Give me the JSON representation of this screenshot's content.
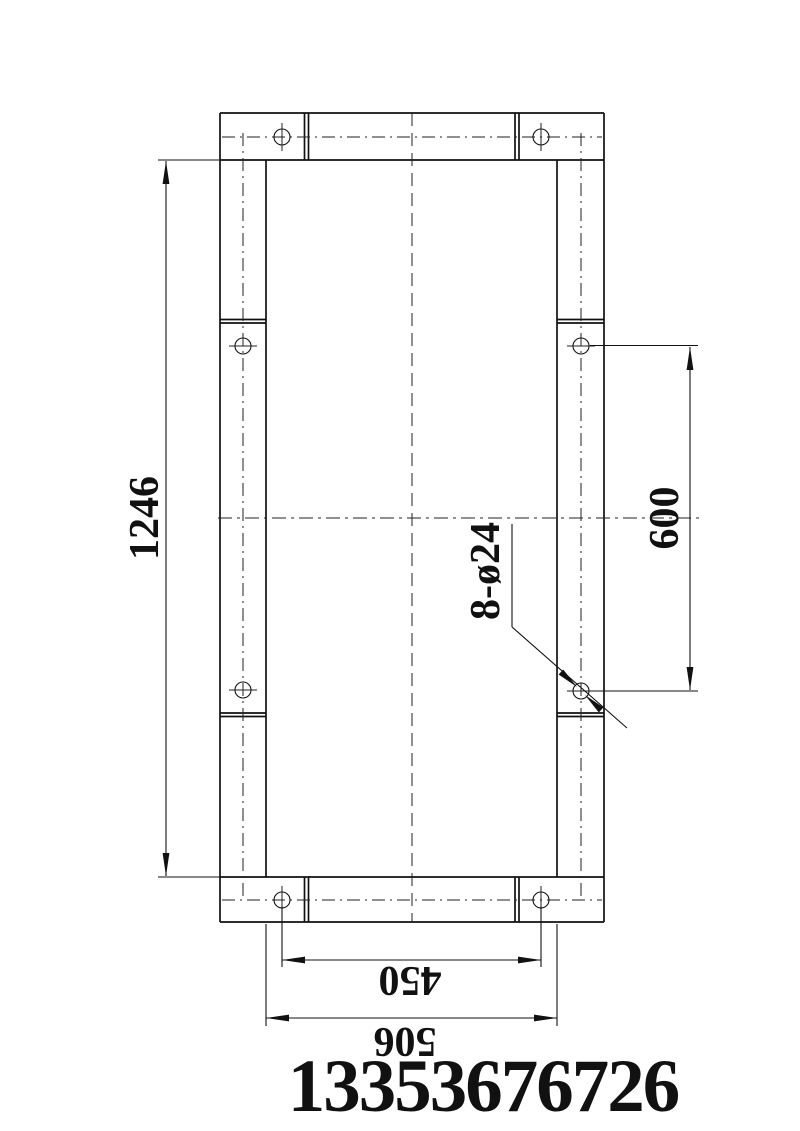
{
  "drawing": {
    "type": "engineering-drawing-frame-plan",
    "labels": {
      "overall_height": "1246",
      "hole_pitch_vertical": "600",
      "holes_callout": "8-ø24",
      "hole_pitch_horizontal": "450",
      "overall_width": "506"
    },
    "footer": {
      "phone_number": "13353676726"
    },
    "colors": {
      "line": "#111111",
      "background": "#ffffff"
    }
  }
}
